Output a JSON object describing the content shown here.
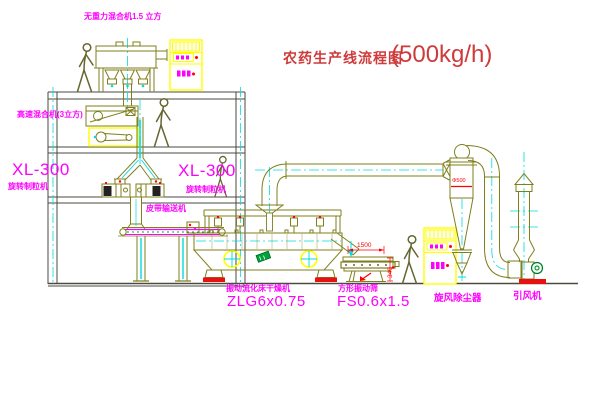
{
  "title": {
    "text": "农药生产线流程图",
    "capacity": "(500kg/h)"
  },
  "labels": {
    "gravity_mixer": "无重力混合机1.5 立方",
    "high_speed_mixer": "高速混合机(3立方)",
    "granulator_left_model": "XL-300",
    "granulator_left_name": "旋转制粒机",
    "granulator_right_model": "XL-300",
    "granulator_right_name": "旋转制粒机",
    "belt_conveyor": "皮带输送机",
    "dryer_name": "振动流化床干燥机",
    "dryer_model": "ZLG6x0.75",
    "screen_name": "方形振动筛",
    "screen_model": "FS0.6x1.5",
    "cyclone": "旋风除尘器",
    "fan": "引风机"
  },
  "dimensions": {
    "screen_length": "1500",
    "screen_height": "340",
    "cyclone_diameter": "Φ500"
  },
  "colors": {
    "machine_line": "#7f7f1e",
    "structure_line": "#4a4a40",
    "centerline": "#00dcdc",
    "label": "#ff00ff",
    "title": "#cf3a3a",
    "dimension": "#ff0000",
    "highlight": "#ffff00",
    "green": "#00a33a"
  }
}
